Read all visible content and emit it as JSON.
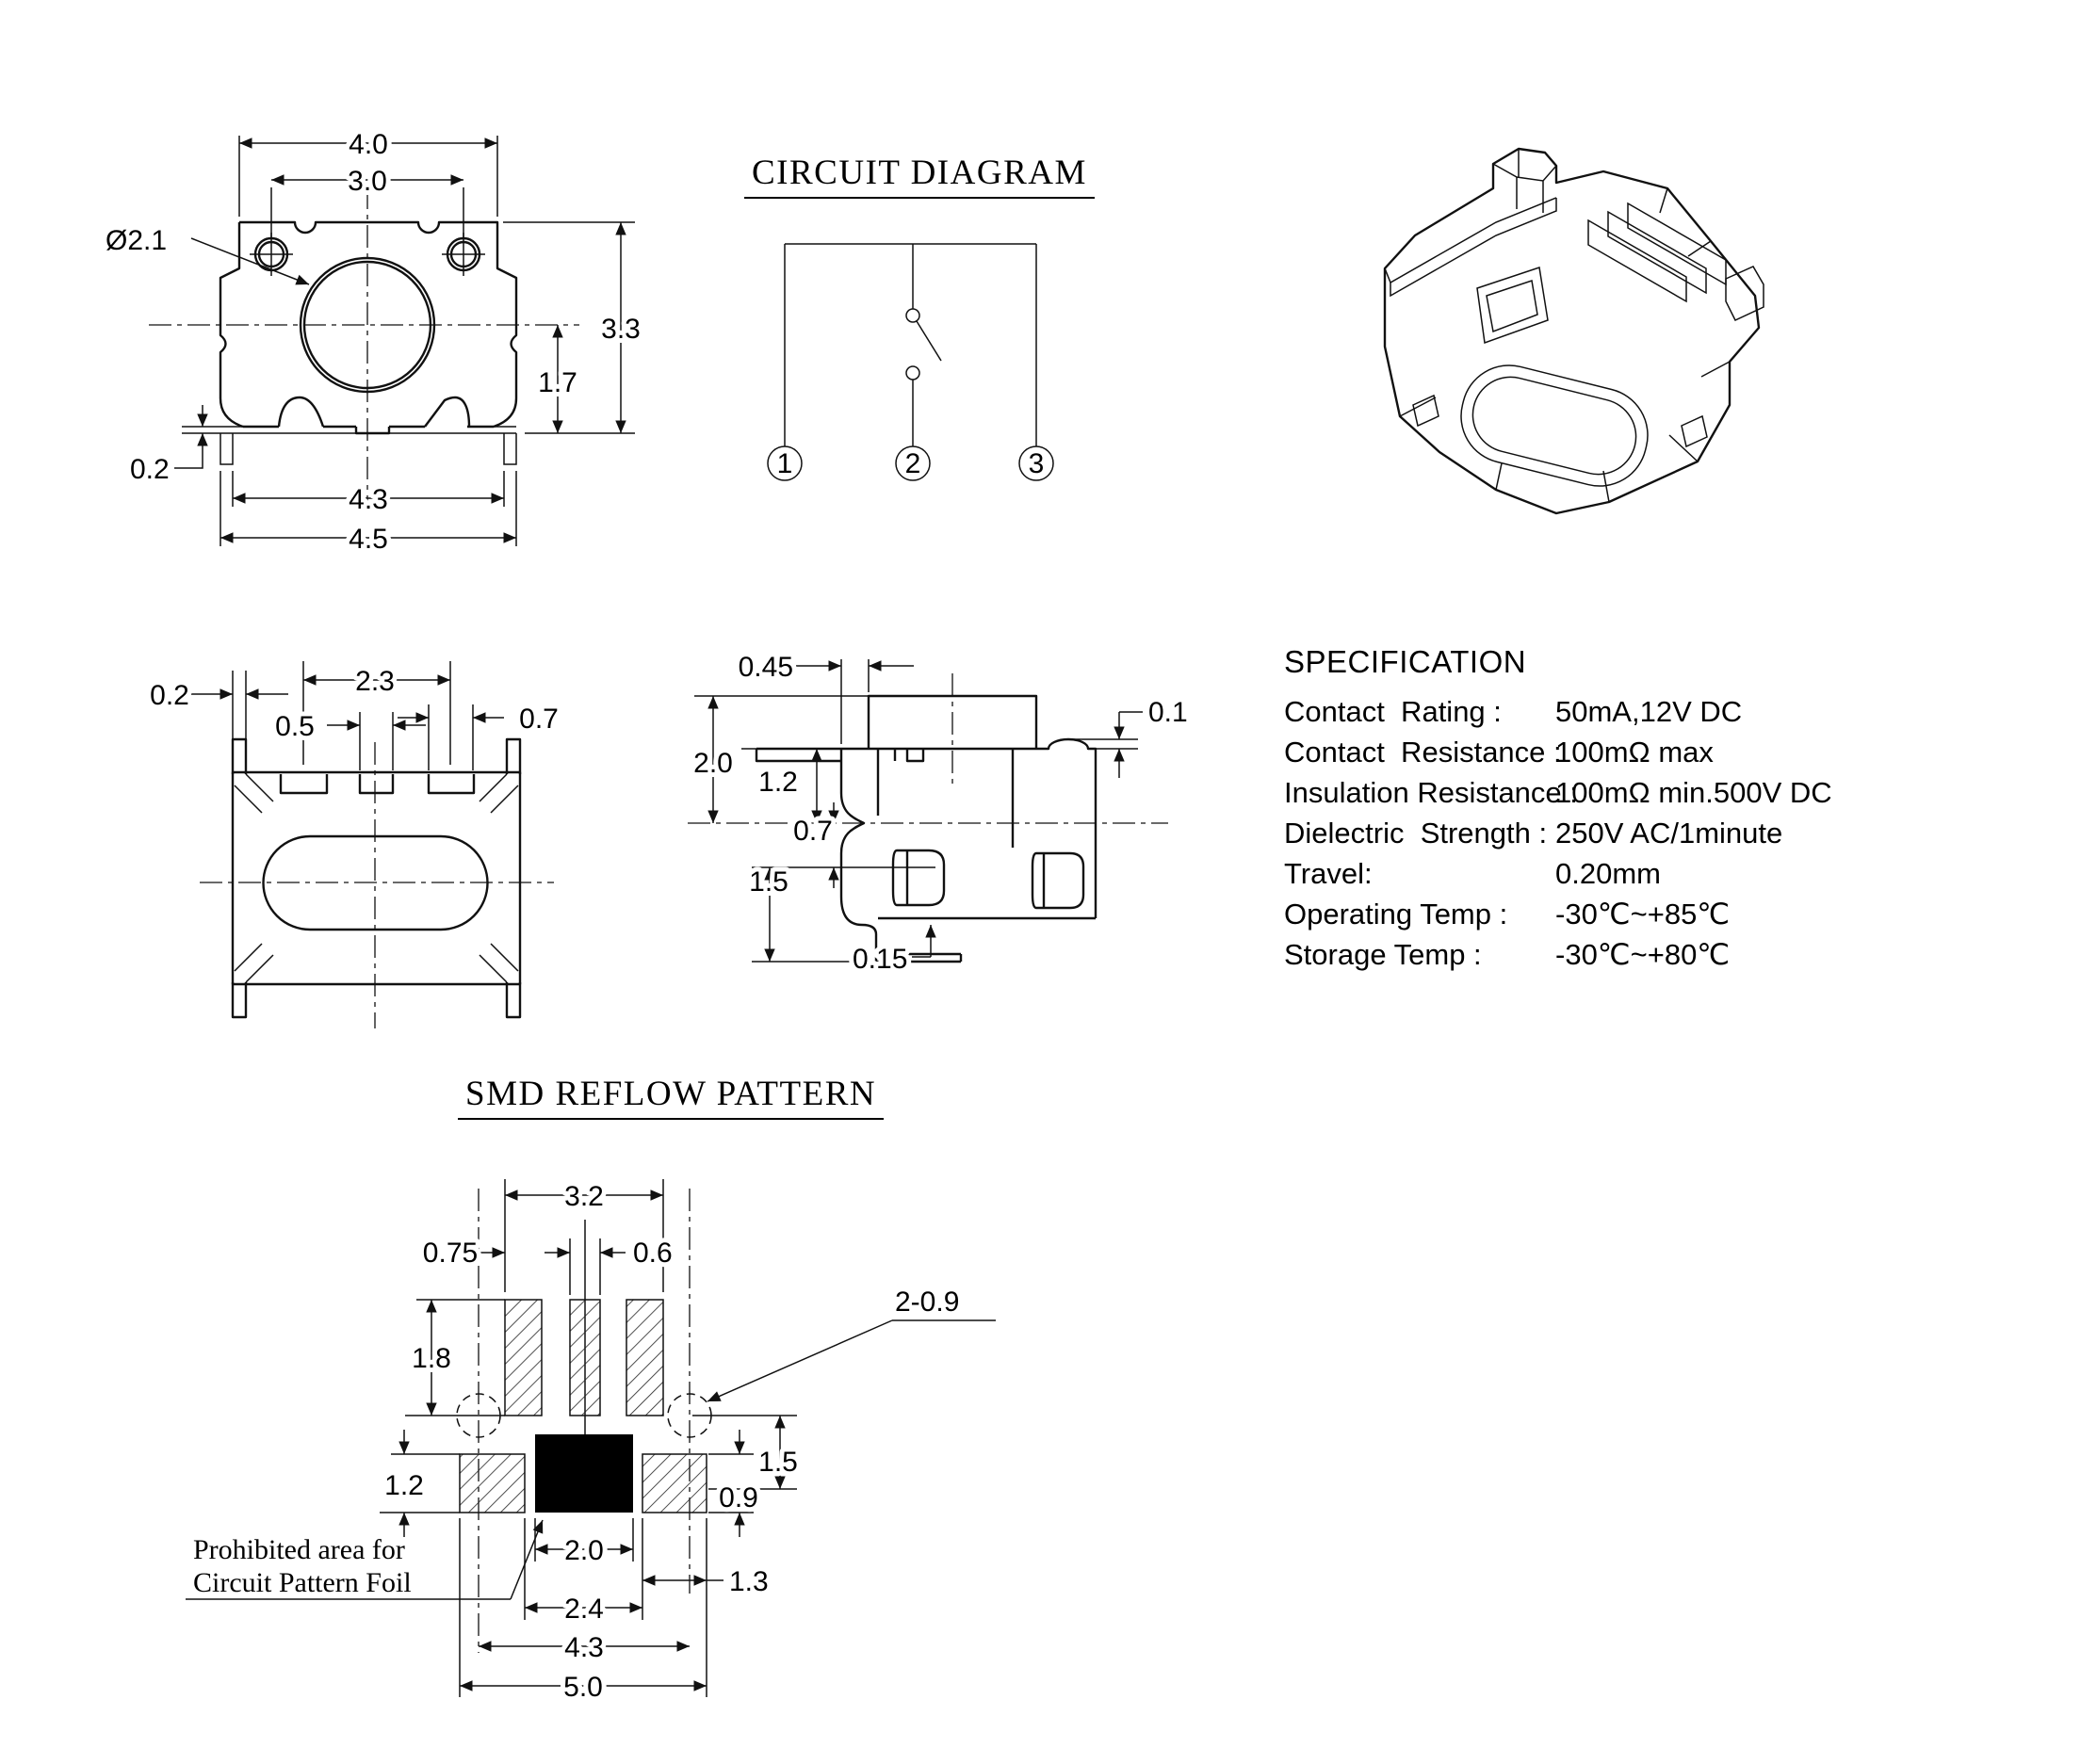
{
  "titles": {
    "circuit": "CIRCUIT DIAGRAM",
    "reflow": "SMD REFLOW PATTERN"
  },
  "top_view": {
    "dims": {
      "w": "4.0",
      "holes": "3.0",
      "dia": "Ø2.1",
      "h": "3.3",
      "lead_h": "1.7",
      "foot_t": "0.2",
      "span_in": "4.3",
      "span_out": "4.5"
    }
  },
  "circuit": {
    "terminals": [
      "1",
      "2",
      "3"
    ]
  },
  "bottom_view": {
    "dims": {
      "t": "0.2",
      "span": "2.3",
      "pad": "0.5",
      "pad2": "0.7"
    }
  },
  "side_view": {
    "dims": {
      "offset": "0.45",
      "bump": "0.1",
      "h": "2.0",
      "body": "1.2",
      "mid": "0.7",
      "lower": "1.5",
      "foot": "0.15"
    }
  },
  "spec": {
    "title": "SPECIFICATION",
    "rows": [
      {
        "label": "Contact  Rating :",
        "value": "50mA,12V DC"
      },
      {
        "label": "Contact  Resistance :",
        "value": "100mΩ max"
      },
      {
        "label": "Insulation Resistance :",
        "value": "100mΩ min.500V DC"
      },
      {
        "label": "Dielectric  Strength :",
        "value": "250V AC/1minute"
      },
      {
        "label": "Travel:",
        "value": "0.20mm"
      },
      {
        "label": "Operating Temp :",
        "value": "-30℃~+85℃"
      },
      {
        "label": "Storage Temp :",
        "value": "-30℃~+80℃"
      }
    ]
  },
  "reflow": {
    "dims": {
      "d32": "3.2",
      "d075": "0.75",
      "d06": "0.6",
      "d209": "2-0.9",
      "d18": "1.8",
      "d12": "1.2",
      "d15": "1.5",
      "d09": "0.9",
      "d20": "2.0",
      "d13": "1.3",
      "d24": "2.4",
      "d43": "4.3",
      "d50": "5.0"
    },
    "note1": "Prohibited area for",
    "note2": "Circuit Pattern Foil"
  }
}
